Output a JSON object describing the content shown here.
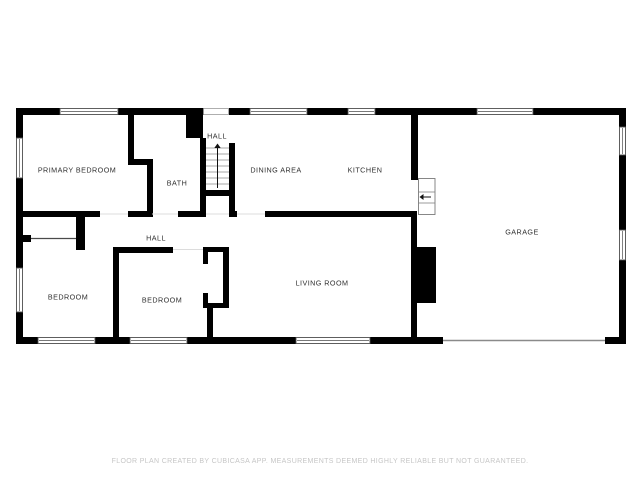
{
  "page": {
    "background": "#ffffff",
    "type_label": "2d-floor-plan"
  },
  "floorplan": {
    "colors": {
      "wall": "#000000",
      "label": "#2f2f2f",
      "window_border": "#4d4d4d",
      "stair_tread": "#8a8a8a",
      "threshold": "#dcdcdc",
      "closet_line": "#4a4a4a",
      "garage_door": "#8a8a8a",
      "opening_border": "#9a9a9a"
    },
    "rooms": [
      {
        "name": "primary-bedroom",
        "label": "PRIMARY BEDROOM",
        "x": 77,
        "y": 170
      },
      {
        "name": "bath",
        "label": "BATH",
        "x": 177,
        "y": 183
      },
      {
        "name": "hall-upper",
        "label": "HALL",
        "x": 217,
        "y": 136
      },
      {
        "name": "dining-area",
        "label": "DINING AREA",
        "x": 276,
        "y": 170
      },
      {
        "name": "kitchen",
        "label": "KITCHEN",
        "x": 365,
        "y": 170
      },
      {
        "name": "garage",
        "label": "GARAGE",
        "x": 522,
        "y": 232
      },
      {
        "name": "hall-lower",
        "label": "HALL",
        "x": 156,
        "y": 238
      },
      {
        "name": "bedroom-left",
        "label": "BEDROOM",
        "x": 68,
        "y": 297
      },
      {
        "name": "bedroom-middle",
        "label": "BEDROOM",
        "x": 162,
        "y": 300
      },
      {
        "name": "living-room",
        "label": "LIVING ROOM",
        "x": 322,
        "y": 283
      }
    ],
    "walls": [
      [
        16,
        108,
        44,
        7
      ],
      [
        118,
        108,
        86,
        7
      ],
      [
        229,
        108,
        21,
        7
      ],
      [
        307,
        108,
        41,
        7
      ],
      [
        375,
        108,
        102,
        7
      ],
      [
        533,
        108,
        93,
        7
      ],
      [
        16,
        108,
        7,
        30
      ],
      [
        16,
        178,
        7,
        90
      ],
      [
        16,
        312,
        7,
        32
      ],
      [
        16,
        337,
        22,
        7
      ],
      [
        95,
        337,
        35,
        7
      ],
      [
        187,
        337,
        109,
        7
      ],
      [
        370,
        337,
        73,
        7
      ],
      [
        605,
        337,
        21,
        7
      ],
      [
        619,
        108,
        7,
        19
      ],
      [
        619,
        155,
        7,
        75
      ],
      [
        619,
        260,
        7,
        84
      ],
      [
        128,
        113,
        6,
        47
      ],
      [
        128,
        159,
        25,
        6
      ],
      [
        147,
        165,
        6,
        52
      ],
      [
        186,
        113,
        17,
        25
      ],
      [
        200,
        138,
        6,
        79
      ],
      [
        202,
        190,
        28,
        6
      ],
      [
        229,
        143,
        6,
        74
      ],
      [
        16,
        211,
        84,
        6
      ],
      [
        128,
        211,
        23,
        6
      ],
      [
        178,
        211,
        24,
        6
      ],
      [
        229,
        211,
        8,
        6
      ],
      [
        265,
        211,
        152,
        6
      ],
      [
        23,
        235,
        8,
        7
      ],
      [
        76,
        217,
        9,
        33
      ],
      [
        113,
        247,
        6,
        90
      ],
      [
        113,
        247,
        60,
        6
      ],
      [
        203,
        247,
        26,
        5
      ],
      [
        223,
        247,
        6,
        61
      ],
      [
        203,
        303,
        26,
        5
      ],
      [
        203,
        252,
        5,
        12
      ],
      [
        203,
        293,
        5,
        10
      ],
      [
        207,
        308,
        6,
        29
      ],
      [
        411,
        111,
        7,
        69
      ],
      [
        411,
        213,
        6,
        124
      ]
    ],
    "windows": [
      [
        60,
        108.5,
        58,
        6
      ],
      [
        250,
        108.5,
        57,
        6
      ],
      [
        348,
        108.5,
        27,
        6
      ],
      [
        477,
        108.5,
        56,
        6
      ],
      [
        38,
        337.5,
        57,
        6
      ],
      [
        130,
        337.5,
        57,
        6
      ],
      [
        296,
        337.5,
        74,
        6
      ],
      [
        16.5,
        138,
        6,
        40
      ],
      [
        16.5,
        268,
        6,
        44
      ],
      [
        619.5,
        127,
        6,
        28
      ],
      [
        619.5,
        230,
        6,
        30
      ]
    ],
    "stairwell_opening": {
      "x": 203.5,
      "y": 108.5,
      "w": 25,
      "h": 6
    },
    "stairs": {
      "x1": 206,
      "x2": 229,
      "treads_y": [
        148,
        154,
        160,
        166,
        172,
        178,
        184
      ],
      "arrow": {
        "x": 217.5,
        "from_y": 188,
        "to_y": 148,
        "tip_y": 143.5,
        "half_w": 3.2
      },
      "direction_label": "up"
    },
    "garage_steps": {
      "x": 418.5,
      "y": 178.5,
      "w": 16.5,
      "h": 36,
      "treads_y": [
        192,
        203
      ],
      "arrow": {
        "y": 197,
        "from_x": 431,
        "to_x": 423.5,
        "tip_x": 419.5,
        "half_h": 3
      }
    },
    "fireplace": {
      "x": 416,
      "y": 247,
      "w": 20,
      "h": 56
    },
    "garage_door_line": {
      "x1": 443,
      "y": 340.5,
      "x2": 605
    },
    "closet_door_line": {
      "x1": 31,
      "y": 238.5,
      "x2": 76
    },
    "thresholds": [
      [
        100,
        214,
        128,
        214
      ],
      [
        152,
        214,
        178,
        214
      ],
      [
        206,
        214,
        229,
        214
      ],
      [
        237,
        214,
        265,
        214
      ],
      [
        173,
        249.5,
        203,
        249.5
      ]
    ]
  },
  "footer": {
    "disclaimer": "FLOOR PLAN CREATED BY CUBICASA APP. MEASUREMENTS DEEMED HIGHLY RELIABLE BUT NOT GUARANTEED.",
    "color": "#c6c6c6",
    "x": 320,
    "y": 463
  }
}
